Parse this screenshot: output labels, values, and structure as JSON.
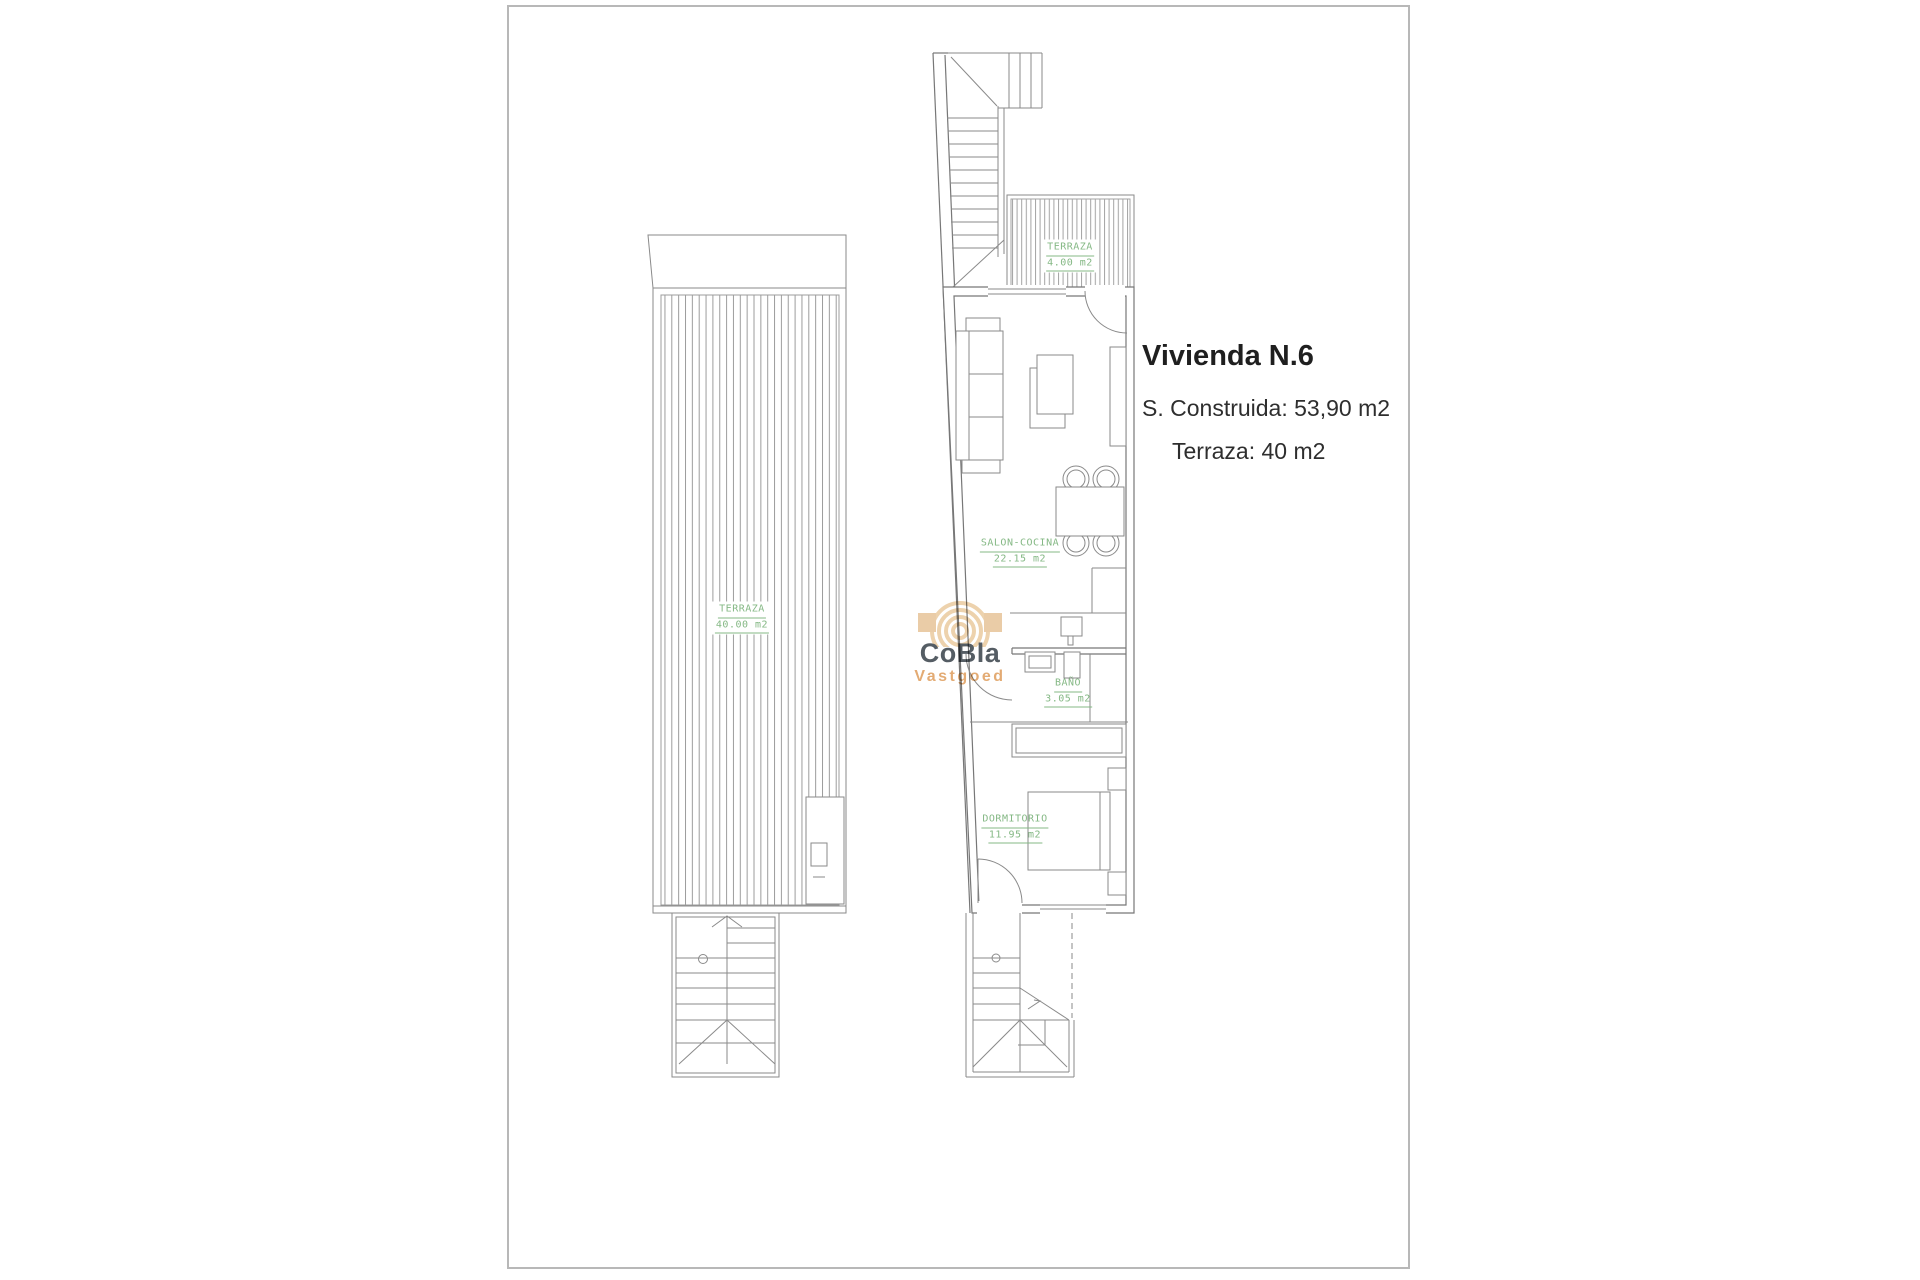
{
  "page": {
    "background": "#ffffff",
    "frame_color": "#b8b8b8"
  },
  "info": {
    "title": "Vivienda N.6",
    "built_area": "S. Construida: 53,90 m2",
    "terrace_area": "Terraza: 40 m2"
  },
  "rooms": {
    "terraza_left": {
      "name": "TERRAZA",
      "area": "40.00 m2"
    },
    "terraza_top": {
      "name": "TERRAZA",
      "area": "4.00 m2"
    },
    "salon": {
      "name": "SALON-COCINA",
      "area": "22.15 m2"
    },
    "bano": {
      "name": "BAÑO",
      "area": "3.05 m2"
    },
    "dormitorio": {
      "name": "DORMITORIO",
      "area": "11.95 m2"
    }
  },
  "logo": {
    "brand": "CoBla",
    "tagline": "Vastgoed"
  },
  "colors": {
    "plan_line": "#8a8a8a",
    "label_green": "#84b884",
    "logo_dark": "#4c545b",
    "logo_tan": "#e2a76c",
    "watermark_tan": "#ecd0a9"
  }
}
